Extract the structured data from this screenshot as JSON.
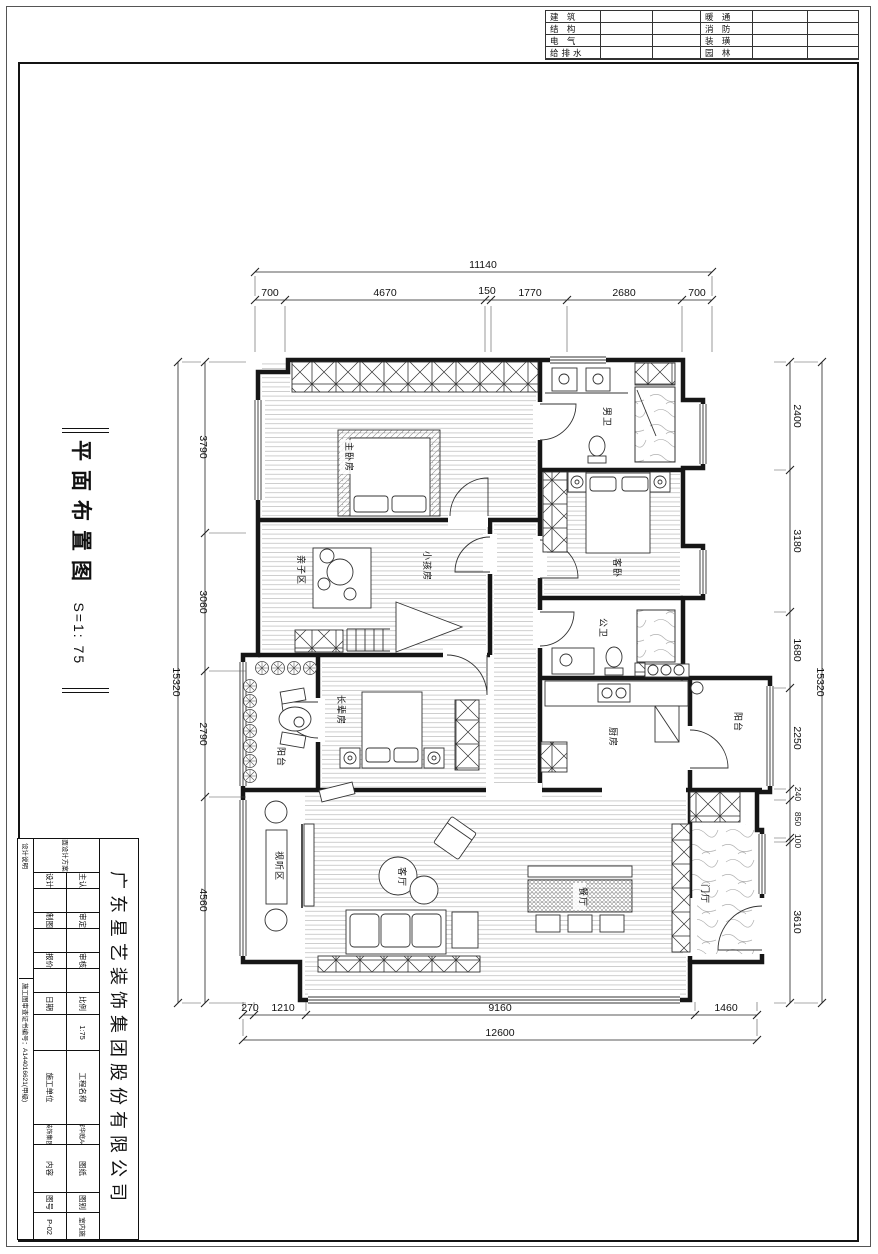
{
  "colors": {
    "ink": "#141414",
    "hatch": "#9a9a9a",
    "marble": "#b0b0b0"
  },
  "header_table": {
    "left_labels": [
      "建 筑",
      "结 构",
      "电 气",
      "给排水"
    ],
    "right_labels": [
      "暖 通",
      "消 防",
      "装 璜",
      "园 林"
    ]
  },
  "sheet_title": {
    "name": "平面布置图",
    "scale": "S=1: 75"
  },
  "plan": {
    "rooms": {
      "master": "主卧房",
      "bath_men": "男卫",
      "guest": "客卧",
      "kids": "小孩房",
      "family": "亲子区",
      "bath_pub": "公卫",
      "elder": "长辈房",
      "balcony_left": "阳台",
      "kitchen": "厨房",
      "balcony_right": "阳台",
      "av_zone": "视听区",
      "living": "客厅",
      "dining": "餐厅",
      "foyer": "门厅"
    }
  },
  "dims": {
    "top": {
      "total": "11140",
      "segs": [
        "700",
        "4670",
        "150",
        "1770",
        "2680",
        "700"
      ]
    },
    "left": {
      "total": "15320",
      "segs": [
        "3790",
        "3060",
        "2790",
        "4560"
      ]
    },
    "right": {
      "total": "15320",
      "segs": [
        "2400",
        "3180",
        "1680",
        "2250",
        "240",
        "850",
        "100",
        "3610"
      ]
    },
    "bottom": {
      "total": "12600",
      "segs": [
        "270",
        "1210",
        "9160",
        "1460"
      ]
    }
  },
  "titleblock": {
    "company": "广东星艺装饰集团股份有限公司",
    "owner_label": "业主认可",
    "approve_label": "审定",
    "check_label": "审核",
    "scale_label": "比例",
    "scale_value": "1:75",
    "design_label": "设计",
    "draft_label": "制图",
    "quote_label": "报价",
    "date_label": "日期",
    "project_label": "工程名称",
    "project_value": "中海锦辉华庭A4栋3201",
    "builder_label": "施工单位",
    "builder_value": "广东星艺装饰集团有限公司",
    "sheet_label": "图纸",
    "content_label": "内容",
    "content_value": "平面设计方案二",
    "cat_label": "图别",
    "cat_value": "室内施",
    "no_label": "图号",
    "no_value": "P-02",
    "strip_note": "设计说明",
    "strip_cert": "施工图审查证书编号：A144016621(甲级)"
  }
}
